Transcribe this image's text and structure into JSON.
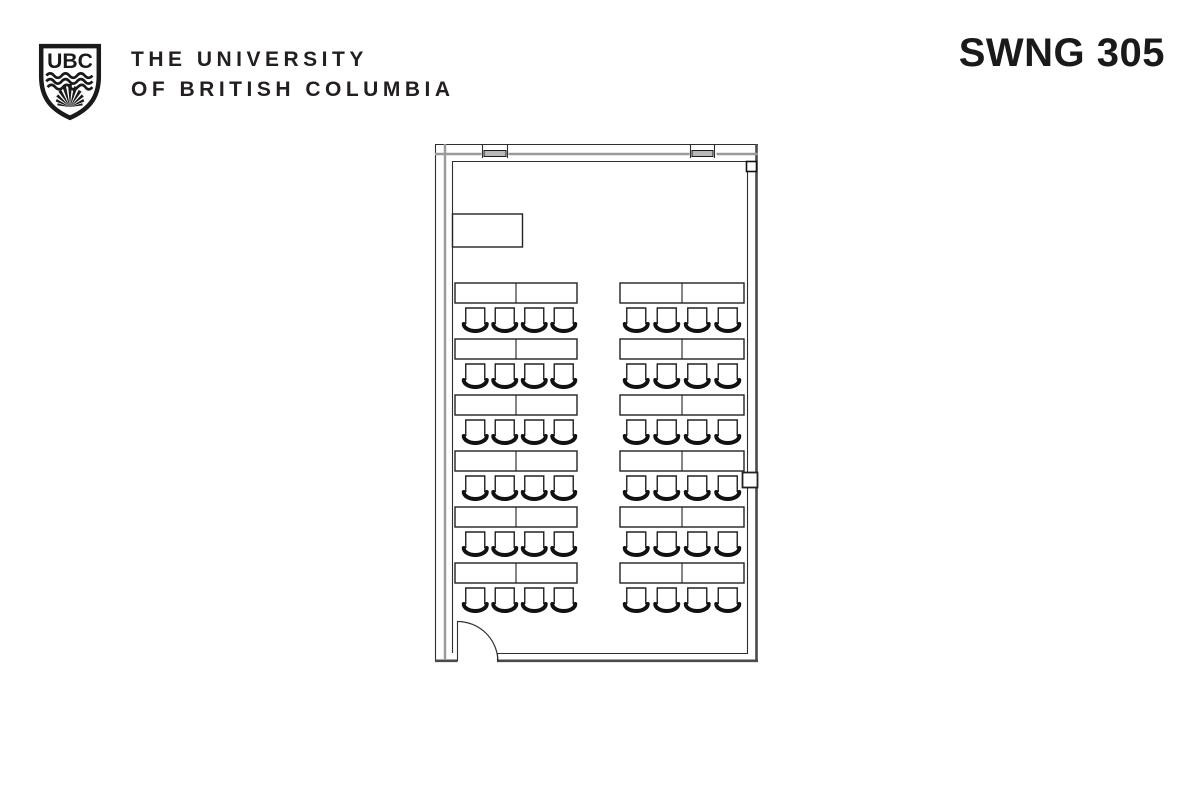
{
  "page": {
    "background": "#ffffff",
    "ink": "#231f20"
  },
  "header": {
    "logo_acronym": "UBC",
    "university_line1": "THE UNIVERSITY",
    "university_line2": "OF BRITISH COLUMBIA",
    "room_label": "SWNG 305"
  },
  "floorplan": {
    "furniture": {
      "rows": 6,
      "row_start_y": 283,
      "row_pitch": 56,
      "table_height": 20,
      "seat_size": 19,
      "seat_depth": 18,
      "seat_gap": 5,
      "columns": [
        {
          "name": "left",
          "x": 455,
          "width": 122,
          "seats": 4,
          "seat_pitch": 29.5,
          "seat_offset": 3.5
        },
        {
          "name": "right",
          "x": 620,
          "width": 124,
          "seats": 4,
          "seat_pitch": 30.5,
          "seat_offset": 0
        }
      ],
      "total_tables": 12,
      "total_seats": 48
    }
  }
}
